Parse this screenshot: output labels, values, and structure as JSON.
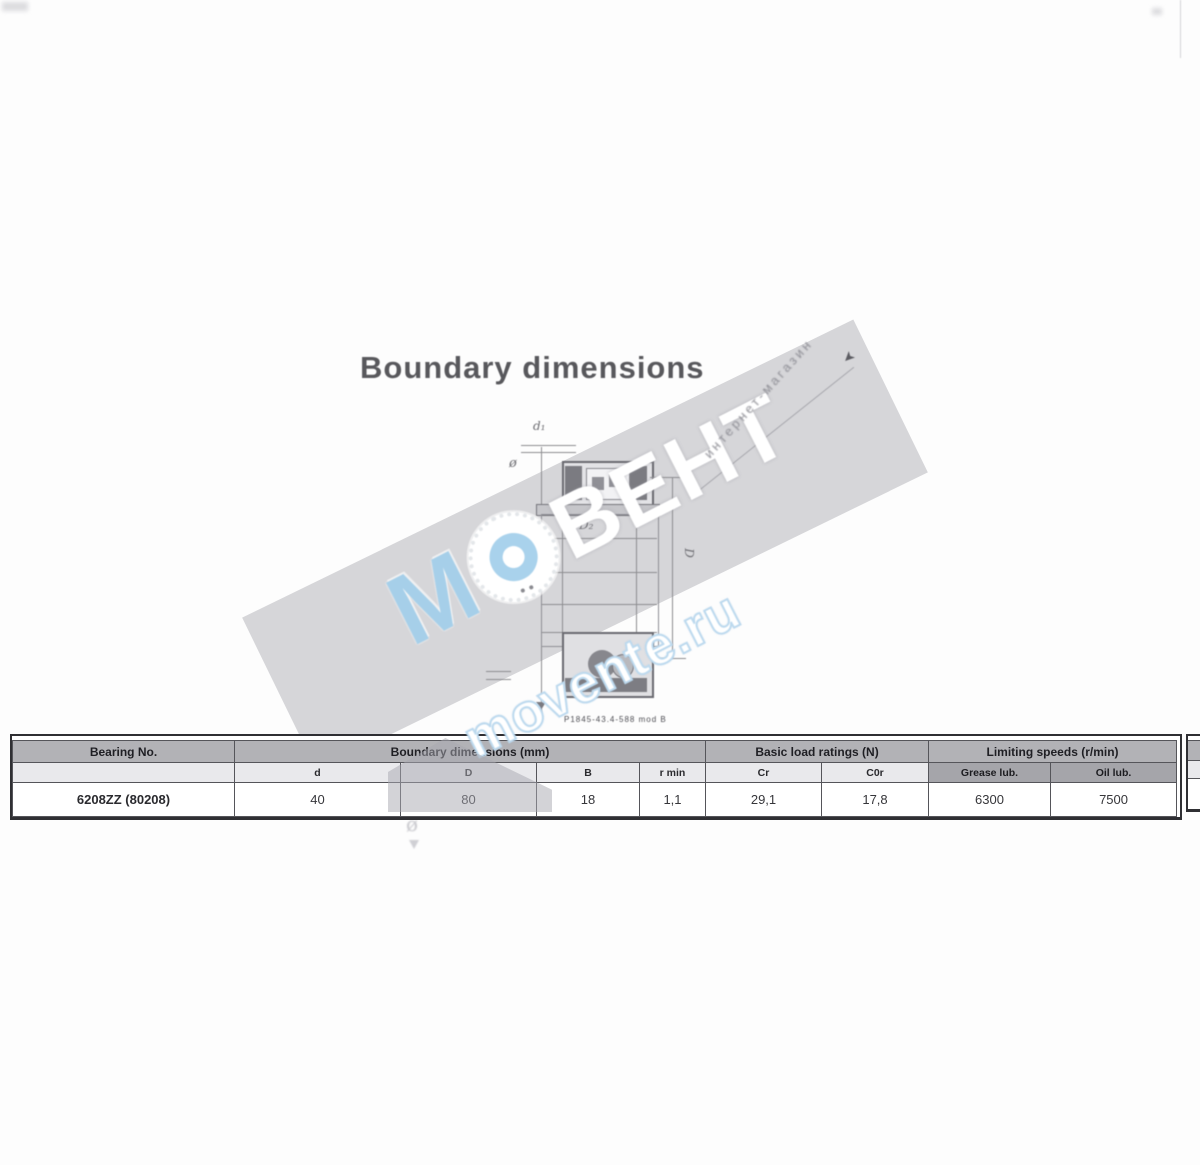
{
  "page": {
    "title": "Boundary dimensions",
    "figure_caption": "P1845-43.4-588 mod B",
    "diagonal_note": "интернет-магазин"
  },
  "drawing": {
    "label_d1": "d₁",
    "label_dia_small": "ø",
    "label_D2": "D₂",
    "label_D": "D",
    "label_dia_bottom": "ø",
    "stray_glyph": "ø"
  },
  "watermark": {
    "letter_m": "М",
    "letters_rest": "ВЕНТ",
    "site": "movente.ru",
    "accent_blue": "#a9d2ec",
    "band_grey": "#ababb2"
  },
  "table": {
    "group_headers": {
      "bearing_no": "Bearing No.",
      "dimensions": "Boundary dimensions (mm)",
      "load_ratings": "Basic load ratings (N)",
      "limiting_speeds": "Limiting speeds (r/min)"
    },
    "sub_headers": {
      "blank": "",
      "d": "d",
      "D": "D",
      "B": "B",
      "r": "r min",
      "cr": "Cr",
      "c0r": "C0r",
      "grease": "Grease lub.",
      "oil": "Oil lub."
    },
    "row": {
      "designation": "6208ZZ (80208)",
      "d": "40",
      "D": "80",
      "B": "18",
      "r": "1,1",
      "cr": "29,1",
      "c0r": "17,8",
      "grease": "6300",
      "oil": "7500"
    }
  }
}
